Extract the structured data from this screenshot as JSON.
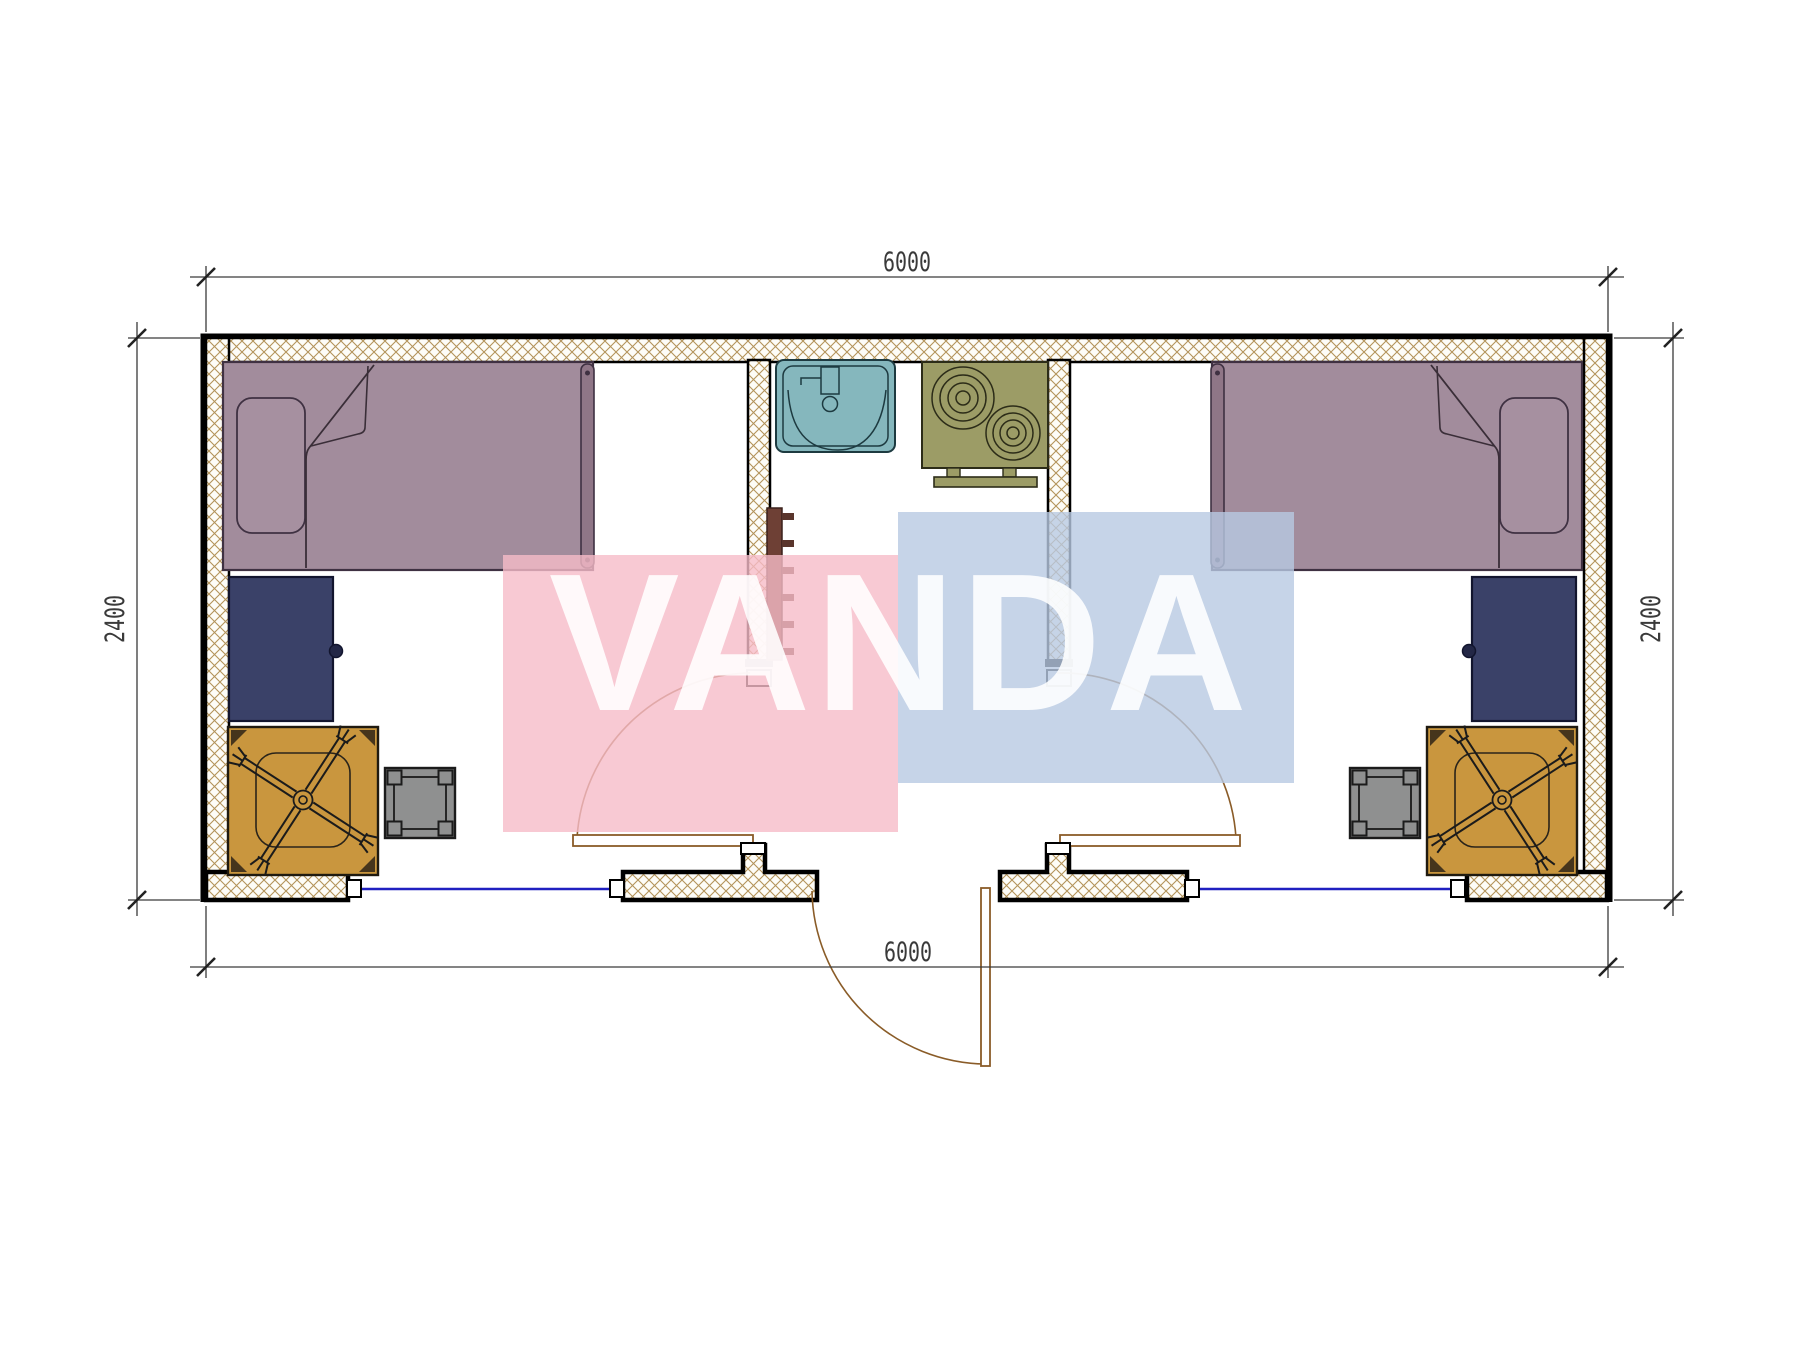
{
  "title": "container-house-floor-plan",
  "dimensions": {
    "width_top": "6000",
    "width_bottom": "6000",
    "height_left": "2400",
    "height_right": "2400"
  },
  "watermark": {
    "text": "VANDA",
    "pink_color": "#f6bcc8",
    "blue_color": "#b8c9e2",
    "text_color": "#ffffff"
  },
  "colors": {
    "bed": "#a28c9c",
    "pillow": "#a690a0",
    "bed_strip": "#8f7687",
    "cabinet": "#3a4168",
    "table": "#c9963e",
    "stool": "#8f9090",
    "sink": "#85b7bd",
    "stove": "#9c9c66",
    "coat_rack": "#6e4035",
    "hatch": "#b3935a",
    "window": "#2020c0",
    "door_swing": "#8a5c28",
    "dim_text": "#3a3a3a"
  },
  "symbols": [
    "single-bed",
    "pillow",
    "wardrobe-cabinet",
    "square-table",
    "swivel-chair",
    "stool",
    "wash-basin",
    "two-burner-cooktop",
    "coat-hooks",
    "door-swing",
    "window-strip"
  ]
}
